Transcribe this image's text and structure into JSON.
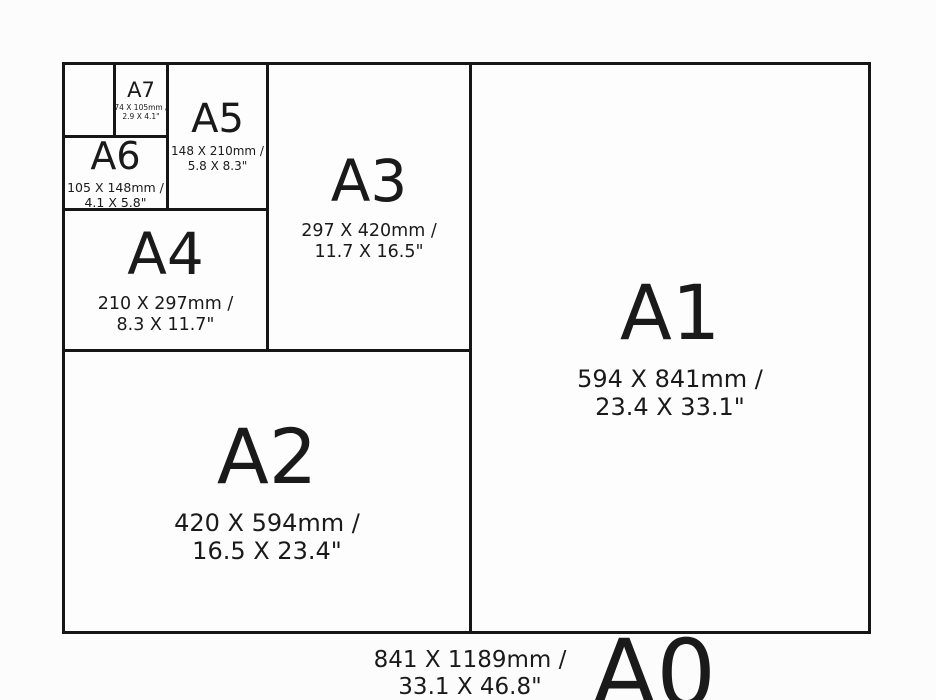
{
  "diagram": {
    "title": "A-series paper sizes comparison",
    "background_color": "#fcfcfc",
    "line_color": "#161616",
    "text_color": "#1a1a1a"
  },
  "sizes": [
    {
      "id": "a0",
      "label": "A0",
      "dims_mm": "841 X 1189mm /",
      "dims_in": "33.1 X 46.8\""
    },
    {
      "id": "a1",
      "label": "A1",
      "dims_mm": "594 X 841mm /",
      "dims_in": "23.4 X 33.1\""
    },
    {
      "id": "a2",
      "label": "A2",
      "dims_mm": "420 X 594mm /",
      "dims_in": "16.5 X 23.4\""
    },
    {
      "id": "a3",
      "label": "A3",
      "dims_mm": "297 X 420mm /",
      "dims_in": "11.7 X 16.5\""
    },
    {
      "id": "a4",
      "label": "A4",
      "dims_mm": "210 X 297mm /",
      "dims_in": "8.3 X 11.7\""
    },
    {
      "id": "a5",
      "label": "A5",
      "dims_mm": "148 X 210mm /",
      "dims_in": "5.8 X 8.3\""
    },
    {
      "id": "a6",
      "label": "A6",
      "dims_mm": "105 X 148mm /",
      "dims_in": "4.1 X 5.8\""
    },
    {
      "id": "a7",
      "label": "A7",
      "dims_mm": "74 X 105mm /",
      "dims_in": "2.9 X 4.1\""
    }
  ]
}
